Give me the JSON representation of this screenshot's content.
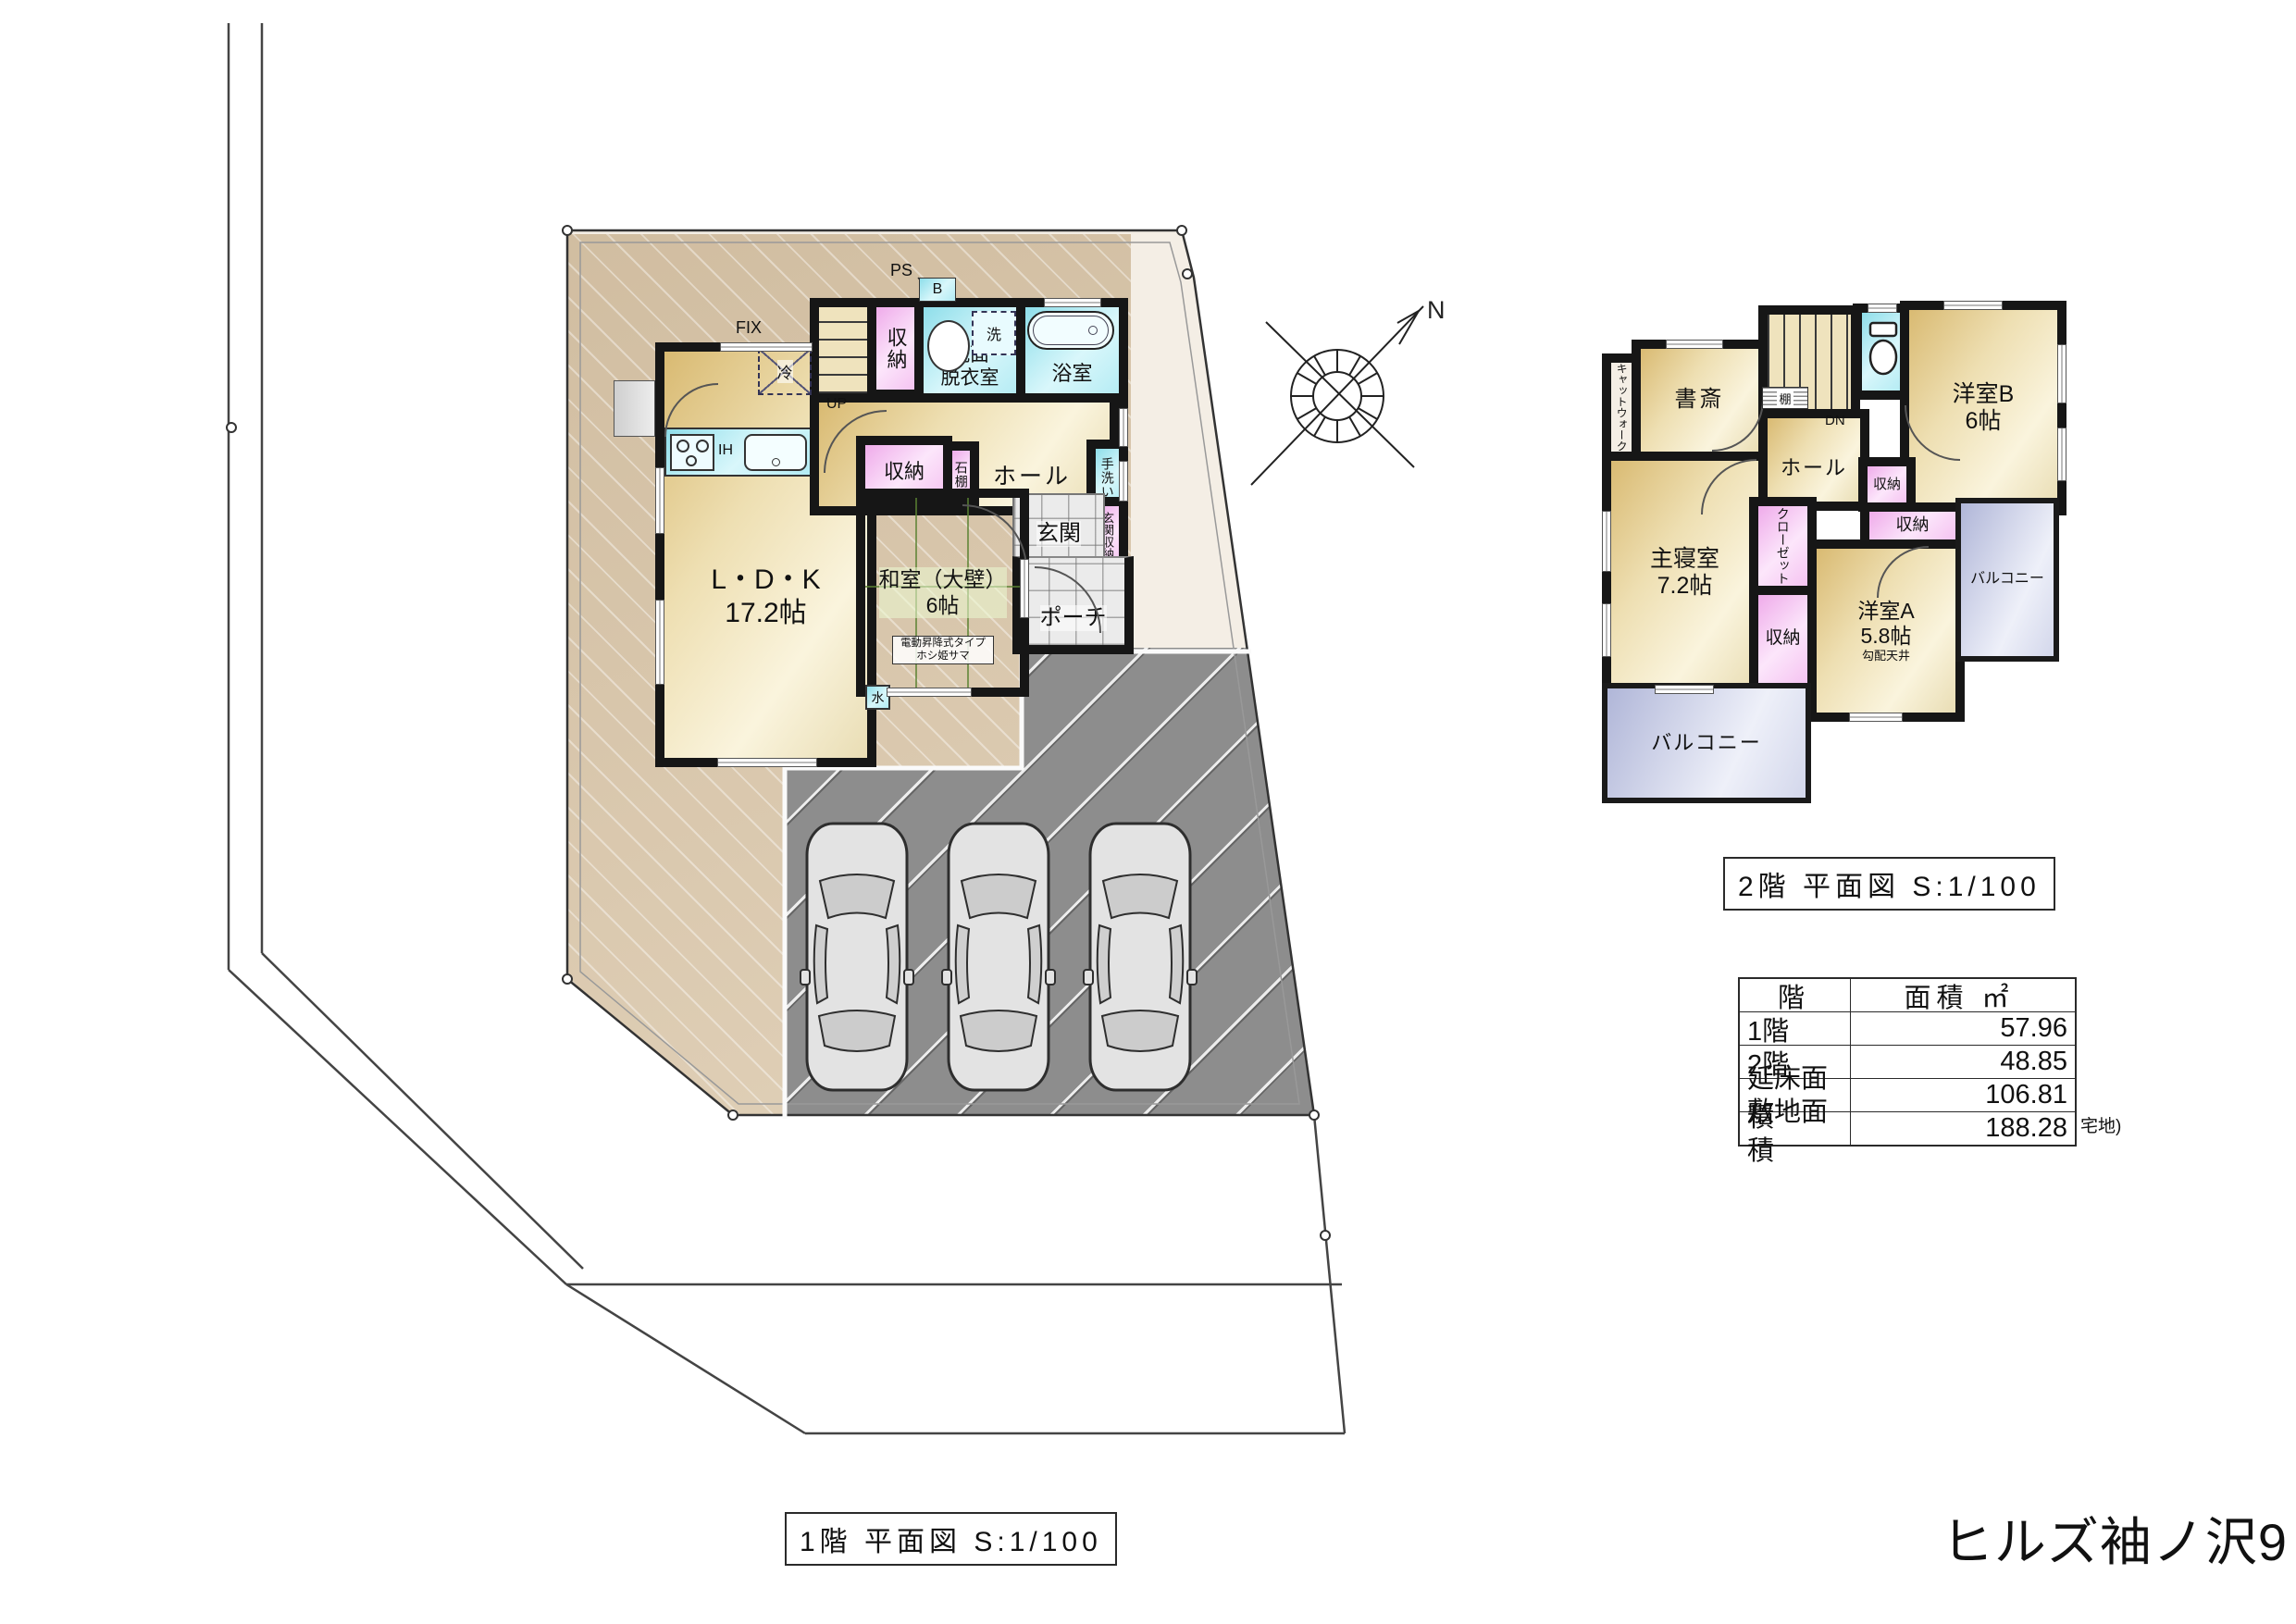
{
  "title": "ヒルズ袖ノ沢9",
  "captions": {
    "floor1": "1階 平面図 S:1/100",
    "floor2": "2階 平面図 S:1/100"
  },
  "area_table": {
    "col_floor": "階",
    "col_area": "面積 ㎡",
    "rows": [
      {
        "label": "1階",
        "value": "57.96"
      },
      {
        "label": "2階",
        "value": "48.85"
      },
      {
        "label": "延床面積",
        "value": "106.81"
      },
      {
        "label": "敷地面積",
        "value": "188.28"
      }
    ],
    "note": "宅地)"
  },
  "labels": {
    "north": "N",
    "storage": "収納",
    "ldk1": "L・D・K",
    "ldk2": "17.2帖",
    "washitsu1": "和室（大壁）",
    "washitsu2": "6帖",
    "hall": "ホール",
    "entrance": "玄関",
    "entrance_storage": "玄関収納",
    "porch": "ポーチ",
    "washroom1": "洗面",
    "washroom2": "脱衣室",
    "bath": "浴室",
    "handwash": "手洗い",
    "stone_shelf": "石棚",
    "washer": "洗",
    "fridge": "冷",
    "boiler": "B",
    "ps": "PS",
    "fix": "FIX",
    "ih": "IH",
    "up": "UP",
    "dn": "DN",
    "water": "水",
    "shelf": "棚",
    "laundry1": "電動昇降式タイプ",
    "laundry2": "ホシ姫サマ",
    "study": "書斎",
    "catwalk": "キャットウォーク",
    "master1": "主寝室",
    "master2": "7.2帖",
    "closet": "クローゼット",
    "western_a1": "洋室A",
    "western_a2": "5.8帖",
    "western_a3": "勾配天井",
    "western_b1": "洋室B",
    "western_b2": "6帖",
    "balcony": "バルコニー"
  },
  "colors": {
    "wall": "#161616",
    "wet_room": "#b2ebf3",
    "storage_pink": "#f5c3f1",
    "tatami_green": "#a5de6c",
    "floor_tan": "#eedfb2",
    "balcony": "#d3d7eb",
    "driveway": "#8d8d8d",
    "site_ground": "#ddcbb0"
  }
}
